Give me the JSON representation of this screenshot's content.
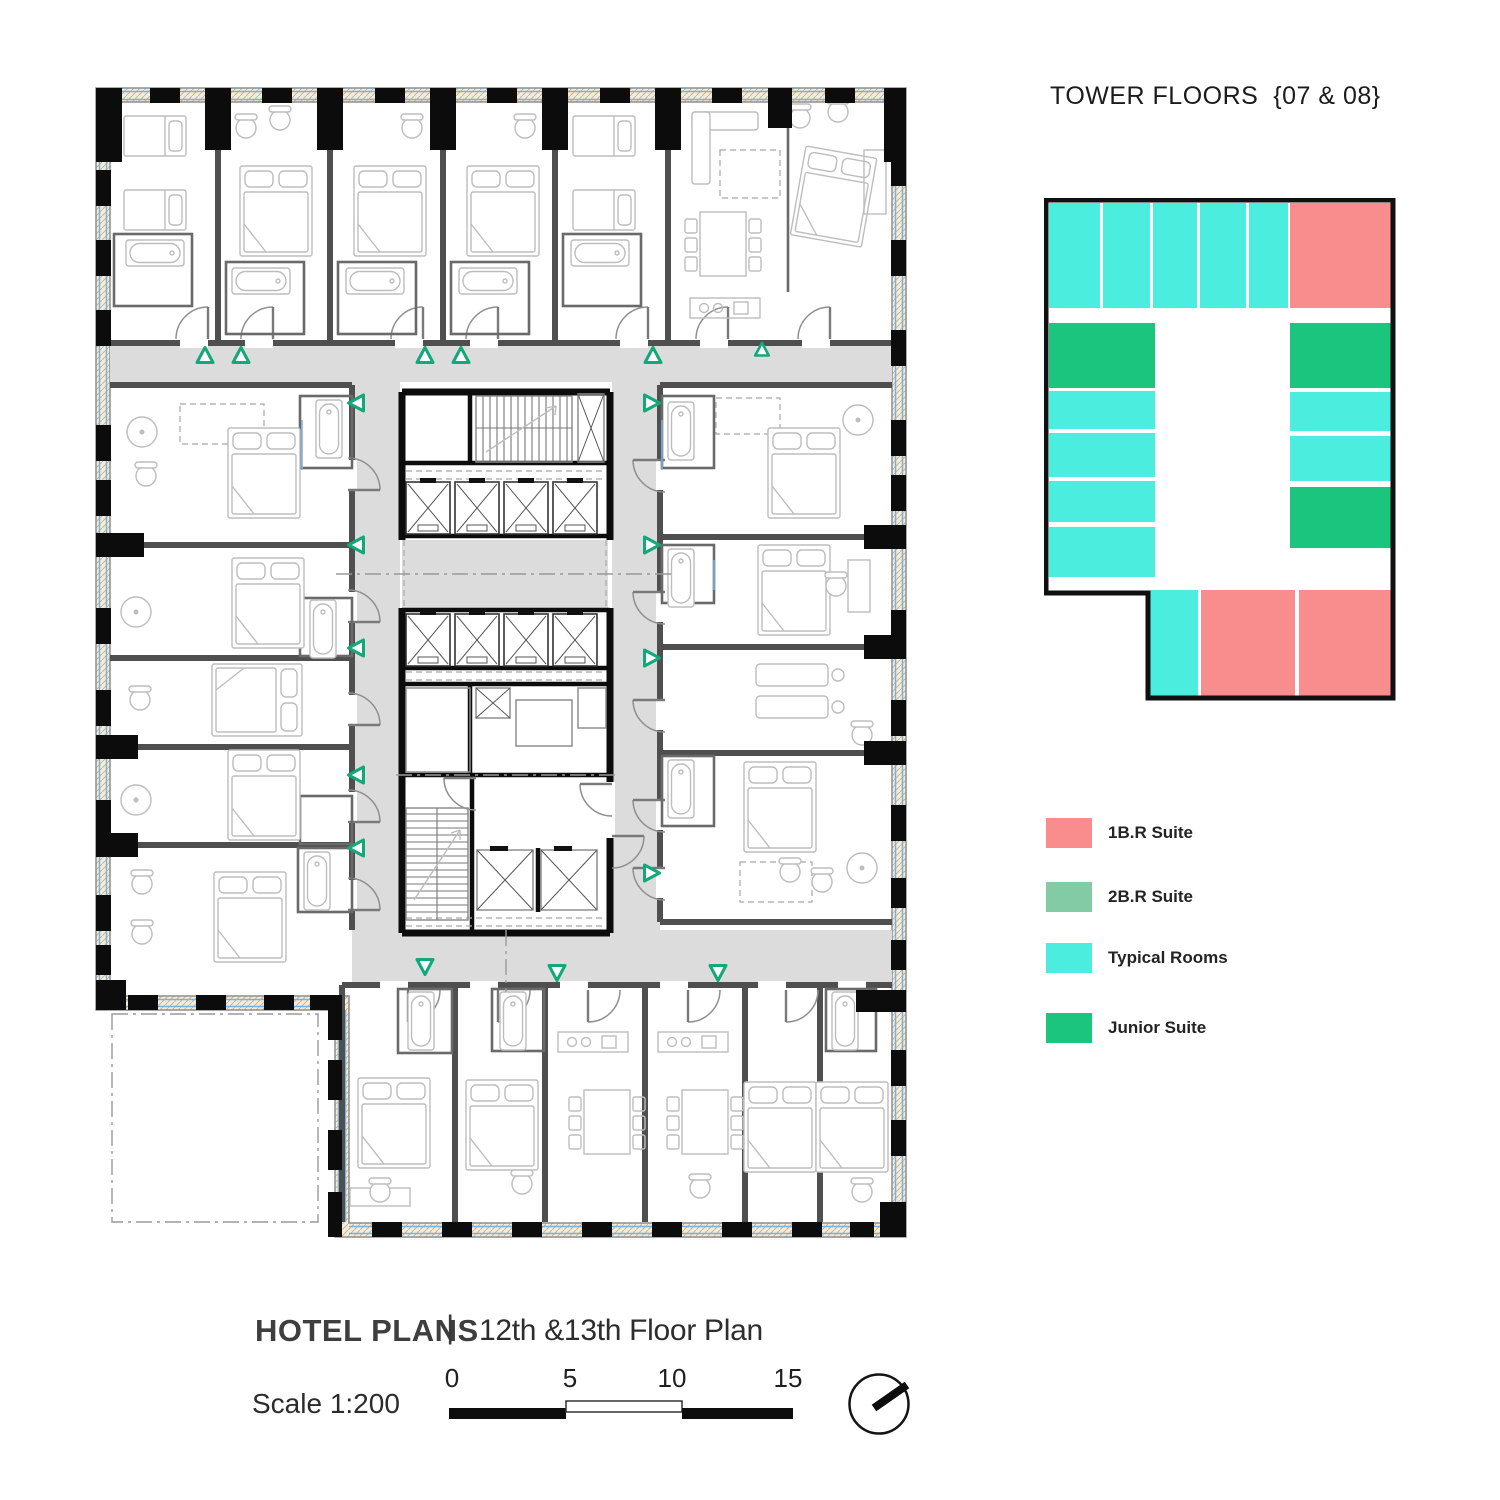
{
  "key_plan": {
    "title": "TOWER FLOORS  {07 & 08}",
    "palette": {
      "suite1br": "#F98D8D",
      "suite2br": "#82CBA4",
      "typical": "#4AEDDE",
      "junior": "#1CC57E"
    },
    "outline_points": "2,2 349,2 349,500 104,500 104,395 2,395",
    "blocks": [
      {
        "x": 5,
        "y": 5,
        "w": 51,
        "h": 105,
        "type": "typical"
      },
      {
        "x": 59,
        "y": 5,
        "w": 47,
        "h": 105,
        "type": "typical"
      },
      {
        "x": 109,
        "y": 5,
        "w": 44,
        "h": 105,
        "type": "typical"
      },
      {
        "x": 156,
        "y": 5,
        "w": 46,
        "h": 105,
        "type": "typical"
      },
      {
        "x": 205,
        "y": 5,
        "w": 39,
        "h": 105,
        "type": "typical"
      },
      {
        "x": 246,
        "y": 5,
        "w": 101,
        "h": 105,
        "type": "suite1br"
      },
      {
        "x": 5,
        "y": 125,
        "w": 106,
        "h": 65,
        "type": "junior"
      },
      {
        "x": 5,
        "y": 193,
        "w": 106,
        "h": 38,
        "type": "typical"
      },
      {
        "x": 5,
        "y": 235,
        "w": 106,
        "h": 44,
        "type": "typical"
      },
      {
        "x": 5,
        "y": 283,
        "w": 106,
        "h": 41,
        "type": "typical"
      },
      {
        "x": 5,
        "y": 329,
        "w": 106,
        "h": 50,
        "type": "typical"
      },
      {
        "x": 246,
        "y": 125,
        "w": 101,
        "h": 65,
        "type": "junior"
      },
      {
        "x": 246,
        "y": 194,
        "w": 101,
        "h": 39,
        "type": "typical"
      },
      {
        "x": 246,
        "y": 238,
        "w": 101,
        "h": 45,
        "type": "typical"
      },
      {
        "x": 246,
        "y": 289,
        "w": 101,
        "h": 61,
        "type": "junior"
      },
      {
        "x": 106,
        "y": 392,
        "w": 48,
        "h": 106,
        "type": "typical"
      },
      {
        "x": 157,
        "y": 392,
        "w": 94,
        "h": 106,
        "type": "suite1br"
      },
      {
        "x": 255,
        "y": 392,
        "w": 92,
        "h": 106,
        "type": "suite1br"
      }
    ]
  },
  "legend": {
    "items": [
      {
        "label": "1B.R Suite",
        "type": "suite1br"
      },
      {
        "label": "2B.R Suite",
        "type": "suite2br"
      },
      {
        "label": "Typical Rooms",
        "type": "typical"
      },
      {
        "label": "Junior Suite",
        "type": "junior"
      }
    ]
  },
  "footer": {
    "title_bold": "HOTEL PLANS",
    "divider": "|",
    "title_regular": "12th &13th Floor Plan",
    "scale_label": "Scale 1:200",
    "scale_ticks": [
      "0",
      "5",
      "10",
      "15"
    ]
  }
}
